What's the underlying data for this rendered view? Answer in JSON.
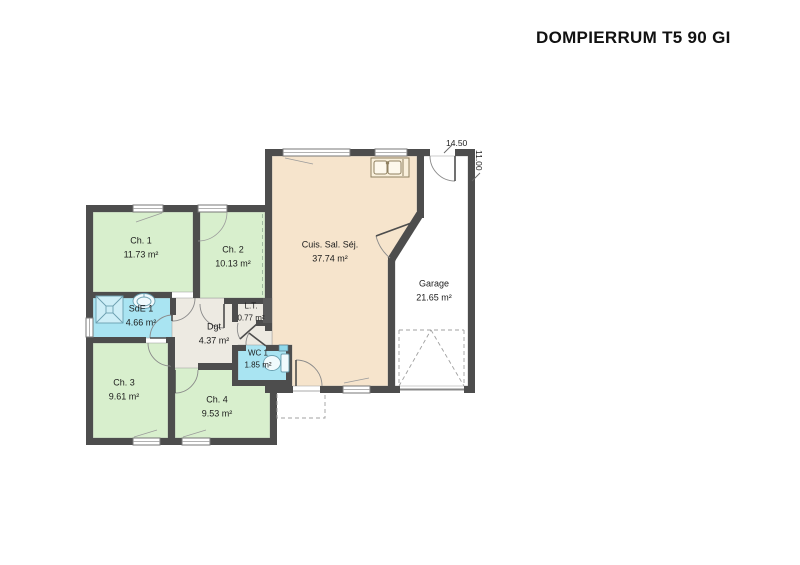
{
  "title": "DOMPIERRUM T5 90 GI",
  "dimensions": {
    "width": "14.50",
    "height": "11.00"
  },
  "rooms": [
    {
      "key": "ch1",
      "name": "Ch. 1",
      "area": "11.73 m²"
    },
    {
      "key": "ch2",
      "name": "Ch. 2",
      "area": "10.13 m²"
    },
    {
      "key": "cuisine_sejour",
      "name": "Cuis. Sal. Séj.",
      "area": "37.74 m²"
    },
    {
      "key": "garage",
      "name": "Garage",
      "area": "21.65 m²"
    },
    {
      "key": "sde1",
      "name": "SdE 1",
      "area": "4.66 m²"
    },
    {
      "key": "lt",
      "name": "L.T.",
      "area": "0.77 m²"
    },
    {
      "key": "dgt",
      "name": "Dgt",
      "area": "4.37 m²"
    },
    {
      "key": "wc1",
      "name": "WC 1",
      "area": "1.85 m²"
    },
    {
      "key": "ch3",
      "name": "Ch. 3",
      "area": "9.61 m²"
    },
    {
      "key": "ch4",
      "name": "Ch. 4",
      "area": "9.53 m²"
    }
  ],
  "colors": {
    "wall": "#4d4d4d",
    "bedroom": "#d8efcd",
    "wet_room": "#a9e4f2",
    "living": "#f6e4cc",
    "hall": "#edeae2",
    "garage": "#ffffff",
    "shower_fill": "#cdeef7",
    "fixture_stroke": "#6a9fb0",
    "door_arc": "#8a8a8a",
    "dashed_line": "#a0a0a0"
  }
}
